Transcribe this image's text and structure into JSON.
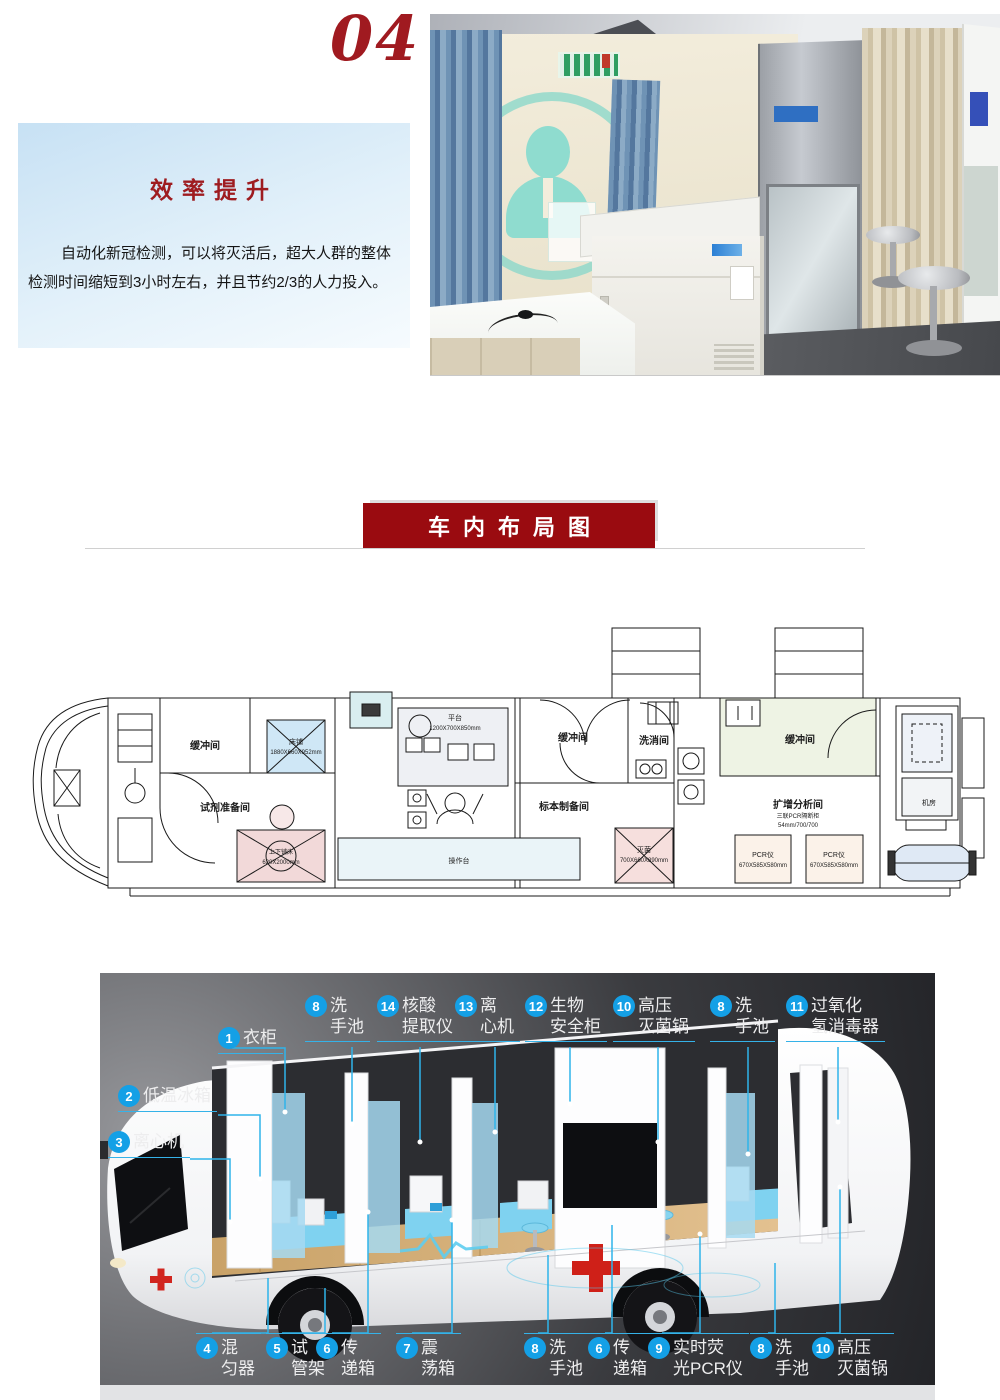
{
  "page": {
    "section_number": "04"
  },
  "efficiency": {
    "title": "效率提升",
    "line1": "自动化新冠检测，可以将灭活后，超大人群的整体",
    "line2": "检测时间缩短到3小时左右，并且节约2/3的人力投入。"
  },
  "banner": {
    "title": "车内布局图"
  },
  "floorplan": {
    "rooms": {
      "buffer_front": "缓冲间",
      "reagent_prep": "试剂准备间",
      "specimen_prep": "标本制备间",
      "buffer_mid": "缓冲间",
      "washing": "洗消间",
      "buffer_rear": "缓冲间",
      "amplification": "扩增分析间",
      "machine_room": "机房"
    },
    "equipment": {
      "bed": "床铺",
      "bed_dims": "1880X660X952mm",
      "bunk": "上下铺床",
      "bunk_dims": "620X2000mm",
      "bench": "平台",
      "bench_dims": "1200X700X850mm",
      "counter": "操作台",
      "sterilizer": "灭菌",
      "sterilizer_dims": "700X660X890mm",
      "pcr": "PCR仪",
      "pcr_dims": "670X585X580mm",
      "amp_note1": "三联PCR隔断柜",
      "amp_note2": "54mm/700/700"
    }
  },
  "diagram": {
    "top": [
      {
        "num": "1",
        "l1": "衣柜",
        "l2": ""
      },
      {
        "num": "8",
        "l1": "洗",
        "l2": "手池"
      },
      {
        "num": "14",
        "l1": "核酸",
        "l2": "提取仪"
      },
      {
        "num": "13",
        "l1": "离",
        "l2": "心机"
      },
      {
        "num": "12",
        "l1": "生物",
        "l2": "安全柜"
      },
      {
        "num": "10",
        "l1": "高压",
        "l2": "灭菌锅"
      },
      {
        "num": "8",
        "l1": "洗",
        "l2": "手池"
      },
      {
        "num": "11",
        "l1": "过氧化",
        "l2": "氢消毒器"
      }
    ],
    "left": [
      {
        "num": "2",
        "l1": "低温冰箱"
      },
      {
        "num": "3",
        "l1": "离心机"
      }
    ],
    "bottom": [
      {
        "num": "4",
        "l1": "混",
        "l2": "匀器"
      },
      {
        "num": "5",
        "l1": "试",
        "l2": "管架"
      },
      {
        "num": "6",
        "l1": "传",
        "l2": "递箱"
      },
      {
        "num": "7",
        "l1": "震",
        "l2": "荡箱"
      },
      {
        "num": "8",
        "l1": "洗",
        "l2": "手池"
      },
      {
        "num": "6",
        "l1": "传",
        "l2": "递箱"
      },
      {
        "num": "9",
        "l1": "实时荧",
        "l2": "光PCR仪"
      },
      {
        "num": "8",
        "l1": "洗",
        "l2": "手池"
      },
      {
        "num": "10",
        "l1": "高压",
        "l2": "灭菌锅"
      }
    ]
  }
}
